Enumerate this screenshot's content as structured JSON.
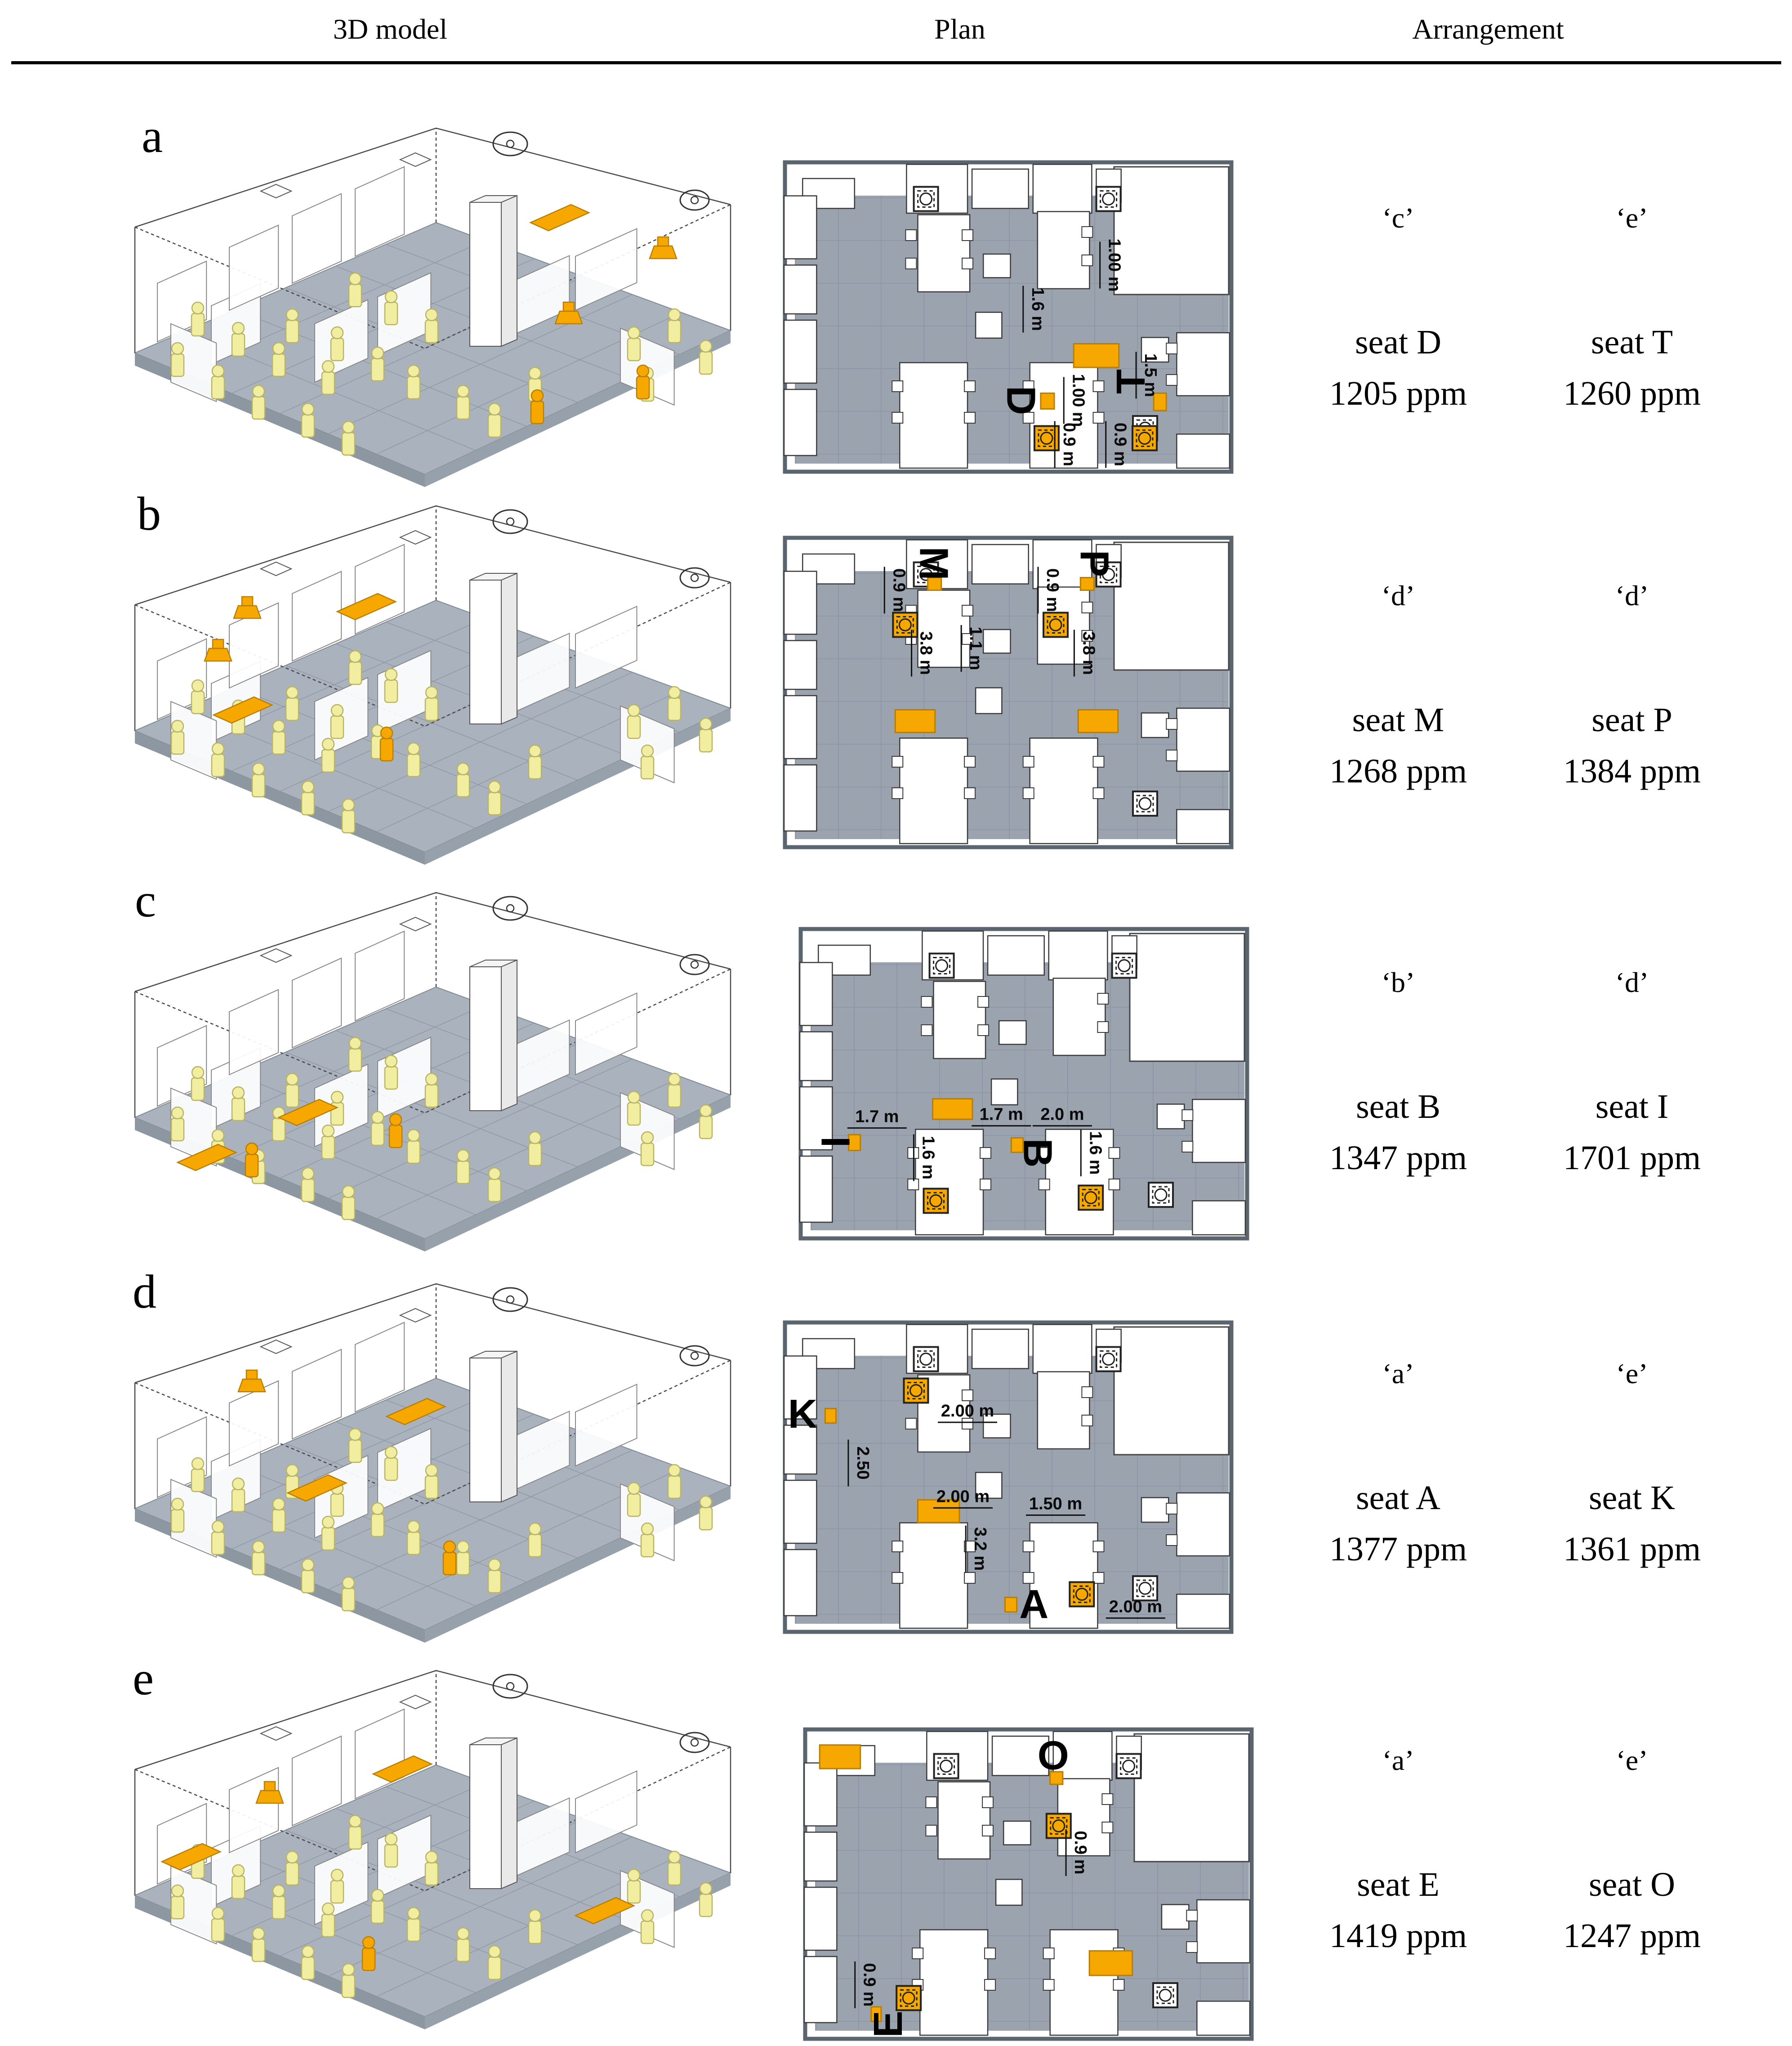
{
  "header": {
    "col_3d": "3D model",
    "col_plan": "Plan",
    "col_arrangement": "Arrangement"
  },
  "colors": {
    "plan_gray": "#9aa3ae",
    "floor_gray": "#aab3bd",
    "orange": "#f7a800",
    "orange_dark": "#b97e00",
    "pale_yellow": "#f1eda1",
    "wall_line": "#555555"
  },
  "rows": [
    {
      "label": "a",
      "arrangement": [
        {
          "condition": "‘c’",
          "seat": "seat D",
          "co2": "1205 ppm"
        },
        {
          "condition": "‘e’",
          "seat": "seat T",
          "co2": "1260 ppm"
        }
      ],
      "plan": {
        "dims": [
          {
            "text": "1.00 m",
            "x": 0.735,
            "y": 0.335,
            "rot": 90
          },
          {
            "text": "1.6 m",
            "x": 0.565,
            "y": 0.475,
            "rot": 90
          },
          {
            "text": "1.00 m",
            "x": 0.655,
            "y": 0.765,
            "rot": 90
          },
          {
            "text": "1.5 m",
            "x": 0.815,
            "y": 0.685,
            "rot": 90
          },
          {
            "text": "0.9 m",
            "x": 0.635,
            "y": 0.905,
            "rot": 90
          },
          {
            "text": "0.9 m",
            "x": 0.748,
            "y": 0.905,
            "rot": 90
          }
        ],
        "seats": [
          {
            "text": "D",
            "x": 0.528,
            "y": 0.765,
            "rot": 90
          },
          {
            "text": "T",
            "x": 0.772,
            "y": 0.705,
            "rot": -90
          }
        ],
        "sensors": [
          {
            "x": 0.585,
            "y": 0.885
          },
          {
            "x": 0.802,
            "y": 0.885
          }
        ],
        "highlights": [
          {
            "x": 0.645,
            "y": 0.585,
            "w": 0.1,
            "h": 0.075
          },
          {
            "x": 0.572,
            "y": 0.742,
            "w": 0.03,
            "h": 0.05
          },
          {
            "x": 0.822,
            "y": 0.742,
            "w": 0.028,
            "h": 0.055
          }
        ]
      }
    },
    {
      "label": "b",
      "arrangement": [
        {
          "condition": "‘d’",
          "seat": "seat M",
          "co2": "1268 ppm"
        },
        {
          "condition": "‘d’",
          "seat": "seat P",
          "co2": "1384 ppm"
        }
      ],
      "plan": {
        "dims": [
          {
            "text": "0.9 m",
            "x": 0.258,
            "y": 0.175,
            "rot": 90
          },
          {
            "text": "3.8 m",
            "x": 0.318,
            "y": 0.375,
            "rot": 90
          },
          {
            "text": "1.1 m",
            "x": 0.428,
            "y": 0.36,
            "rot": 90
          },
          {
            "text": "0.9 m",
            "x": 0.598,
            "y": 0.175,
            "rot": 90
          },
          {
            "text": "3.8 m",
            "x": 0.678,
            "y": 0.375,
            "rot": 90
          }
        ],
        "seats": [
          {
            "text": "M",
            "x": 0.335,
            "y": 0.09,
            "rot": 90
          },
          {
            "text": "P",
            "x": 0.69,
            "y": 0.09,
            "rot": 90
          }
        ],
        "sensors": [
          {
            "x": 0.272,
            "y": 0.285
          },
          {
            "x": 0.605,
            "y": 0.285
          }
        ],
        "highlights": [
          {
            "x": 0.25,
            "y": 0.555,
            "w": 0.088,
            "h": 0.072
          },
          {
            "x": 0.655,
            "y": 0.555,
            "w": 0.088,
            "h": 0.072
          },
          {
            "x": 0.322,
            "y": 0.135,
            "w": 0.03,
            "h": 0.04
          },
          {
            "x": 0.66,
            "y": 0.135,
            "w": 0.03,
            "h": 0.04
          }
        ]
      }
    },
    {
      "label": "c",
      "arrangement": [
        {
          "condition": "‘b’",
          "seat": "seat B",
          "co2": "1347 ppm"
        },
        {
          "condition": "‘d’",
          "seat": "seat I",
          "co2": "1701 ppm"
        }
      ],
      "plan": {
        "dims": [
          {
            "text": "1.7 m",
            "x": 0.175,
            "y": 0.605,
            "rot": 0
          },
          {
            "text": "1.7 m",
            "x": 0.45,
            "y": 0.598,
            "rot": 0
          },
          {
            "text": "2.0 m",
            "x": 0.585,
            "y": 0.598,
            "rot": 0
          },
          {
            "text": "1.6 m",
            "x": 0.288,
            "y": 0.735,
            "rot": 90
          },
          {
            "text": "1.6 m",
            "x": 0.658,
            "y": 0.72,
            "rot": 90
          }
        ],
        "seats": [
          {
            "text": "I",
            "x": 0.082,
            "y": 0.685,
            "rot": 90
          },
          {
            "text": "B",
            "x": 0.53,
            "y": 0.72,
            "rot": 90
          }
        ],
        "sensors": [
          {
            "x": 0.305,
            "y": 0.872
          },
          {
            "x": 0.648,
            "y": 0.862
          }
        ],
        "highlights": [
          {
            "x": 0.298,
            "y": 0.548,
            "w": 0.088,
            "h": 0.065
          },
          {
            "x": 0.112,
            "y": 0.662,
            "w": 0.026,
            "h": 0.05
          },
          {
            "x": 0.472,
            "y": 0.672,
            "w": 0.026,
            "h": 0.046
          }
        ]
      }
    },
    {
      "label": "d",
      "arrangement": [
        {
          "condition": "‘a’",
          "seat": "seat A",
          "co2": "1377 ppm"
        },
        {
          "condition": "‘e’",
          "seat": "seat K",
          "co2": "1361 ppm"
        }
      ],
      "plan": {
        "dims": [
          {
            "text": "2.00 m",
            "x": 0.41,
            "y": 0.29,
            "rot": 0
          },
          {
            "text": "2.50",
            "x": 0.178,
            "y": 0.455,
            "rot": 90
          },
          {
            "text": "2.00 m",
            "x": 0.4,
            "y": 0.562,
            "rot": 0
          },
          {
            "text": "1.50 m",
            "x": 0.605,
            "y": 0.585,
            "rot": 0
          },
          {
            "text": "3.2 m",
            "x": 0.438,
            "y": 0.728,
            "rot": 90
          },
          {
            "text": "2.00 m",
            "x": 0.782,
            "y": 0.912,
            "rot": 0
          }
        ],
        "seats": [
          {
            "text": "K",
            "x": 0.045,
            "y": 0.3,
            "rot": 0
          },
          {
            "text": "A",
            "x": 0.557,
            "y": 0.905,
            "rot": 0
          }
        ],
        "sensors": [
          {
            "x": 0.296,
            "y": 0.225
          },
          {
            "x": 0.663,
            "y": 0.872
          }
        ],
        "highlights": [
          {
            "x": 0.3,
            "y": 0.572,
            "w": 0.092,
            "h": 0.072
          },
          {
            "x": 0.095,
            "y": 0.282,
            "w": 0.024,
            "h": 0.046
          },
          {
            "x": 0.493,
            "y": 0.882,
            "w": 0.026,
            "h": 0.046
          }
        ]
      }
    },
    {
      "label": "e",
      "arrangement": [
        {
          "condition": "‘a’",
          "seat": "seat E",
          "co2": "1419 ppm"
        },
        {
          "condition": "‘e’",
          "seat": "seat O",
          "co2": "1247 ppm"
        }
      ],
      "plan": {
        "dims": [
          {
            "text": "0.9 m",
            "x": 0.615,
            "y": 0.4,
            "rot": 90
          },
          {
            "text": "0.9 m",
            "x": 0.148,
            "y": 0.82,
            "rot": 90
          }
        ],
        "seats": [
          {
            "text": "O",
            "x": 0.555,
            "y": 0.092,
            "rot": 0
          },
          {
            "text": "E",
            "x": 0.19,
            "y": 0.945,
            "rot": -90
          }
        ],
        "sensors": [
          {
            "x": 0.567,
            "y": 0.315
          },
          {
            "x": 0.235,
            "y": 0.862
          }
        ],
        "highlights": [
          {
            "x": 0.038,
            "y": 0.058,
            "w": 0.09,
            "h": 0.075
          },
          {
            "x": 0.635,
            "y": 0.712,
            "w": 0.095,
            "h": 0.078
          },
          {
            "x": 0.548,
            "y": 0.143,
            "w": 0.028,
            "h": 0.04
          },
          {
            "x": 0.152,
            "y": 0.89,
            "w": 0.022,
            "h": 0.046
          }
        ]
      }
    }
  ]
}
